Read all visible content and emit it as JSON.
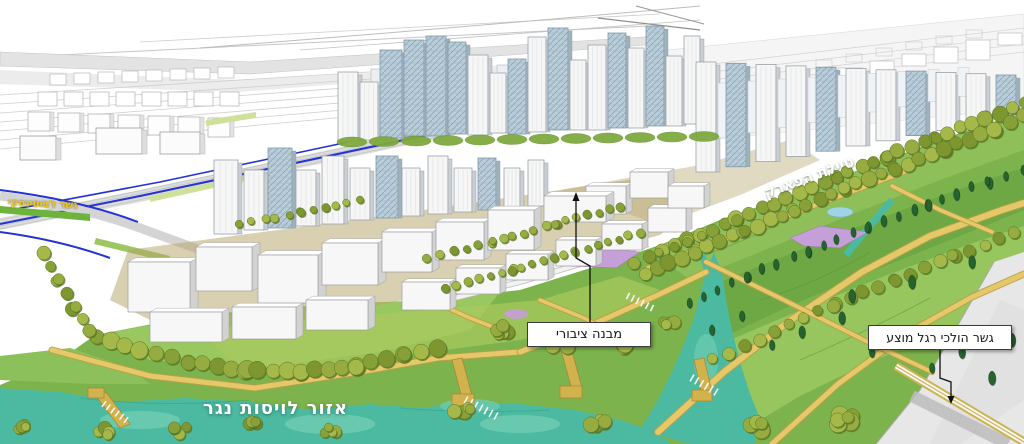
{
  "scene": {
    "colors": {
      "park": "#7cb34c",
      "meadow_light": "#9cc963",
      "meadow_lime": "#8fbf58",
      "meadow_dark": "#6da844",
      "water": "#4cbaa0",
      "water_light": "#6fcdb2",
      "path_yellow": "#e5c968",
      "path_edge": "#bb9c4c",
      "pier": "#d2b24c",
      "tree_olive": "#8da43e",
      "tree_conifer": "#27632f",
      "flower_purple": "#c49fd8",
      "glass_tower": "#b9cdda",
      "building_white": "#f6f6f6",
      "road_blue": "#2334d4",
      "annotation_ink": "#111111"
    }
  },
  "annotations": {
    "public_building": {
      "label": "מבנה ציבורי",
      "type": "boxed-callout"
    },
    "pedestrian_bridge": {
      "label": "גשר הולכי רגל מוצע",
      "type": "boxed-callout"
    },
    "runoff_area": {
      "label": "אזור לויסות נגר",
      "type": "text-on-water"
    },
    "park_promenade": {
      "label": "טיילת הפארק",
      "type": "rotated-text"
    },
    "jabotinsky_bridge": {
      "label": "גשר ז'בוטינסקי",
      "type": "small-text"
    }
  }
}
